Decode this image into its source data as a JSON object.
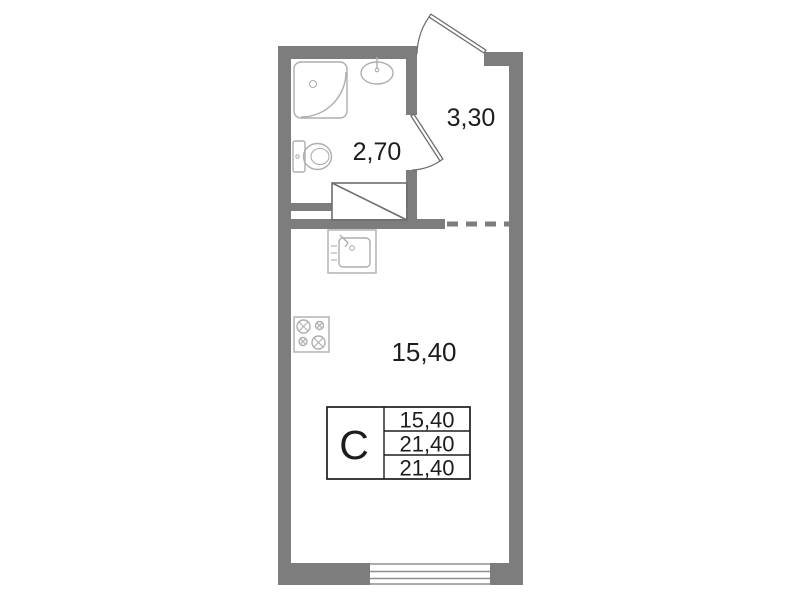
{
  "rooms": {
    "bathroom": {
      "area": "2,70"
    },
    "hallway": {
      "area": "3,30"
    },
    "living": {
      "area": "15,40"
    }
  },
  "stamp": {
    "type_label": "С",
    "rows": [
      "15,40",
      "21,40",
      "21,40"
    ]
  },
  "icons": [
    "entry-door-icon",
    "bathroom-door-icon",
    "shower-icon",
    "bathroom-sink-icon",
    "toilet-icon",
    "wardrobe-icon",
    "kitchen-sink-icon",
    "stove-icon",
    "window-icon",
    "dashed-boundary-line"
  ],
  "colors": {
    "wall": "#7d7d7d",
    "fixture": "#aeaeae",
    "line": "#6e6e6e",
    "text": "#1d1d1d",
    "background": "#ffffff"
  }
}
